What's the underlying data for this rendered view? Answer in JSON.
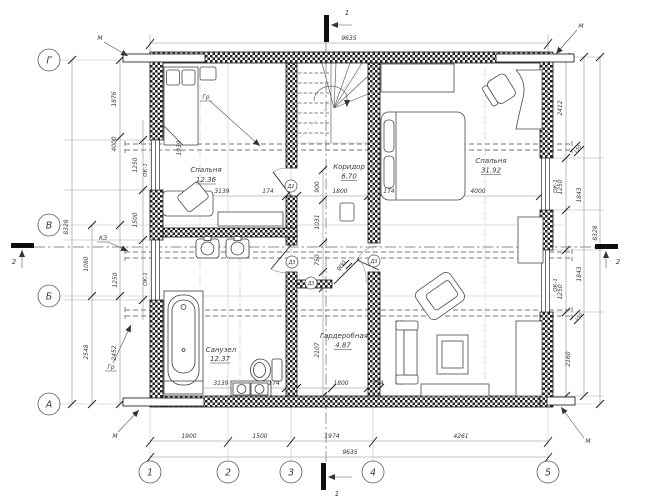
{
  "axes": {
    "rows": [
      "Г",
      "В",
      "Б",
      "А"
    ],
    "cols": [
      "1",
      "2",
      "3",
      "4",
      "5"
    ]
  },
  "sections": {
    "s1": "1",
    "s2": "2"
  },
  "rooms": [
    {
      "name": "Спальня",
      "area": "12.36"
    },
    {
      "name": "Коридор",
      "area": "6.70"
    },
    {
      "name": "Спальня",
      "area": "31.92"
    },
    {
      "name": "Санузел",
      "area": "12.37"
    },
    {
      "name": "Гардеробная",
      "area": "4.87"
    }
  ],
  "labels": {
    "window": "ОК-1",
    "door_d2": "Д2",
    "door_d3": "Д3",
    "corner_mark": "М",
    "floor_mark": "Гр",
    "kz_mark": "КЗ"
  },
  "dims": {
    "top_total": "9635",
    "bottom_segments": [
      "1900",
      "1500",
      "1974",
      "4261"
    ],
    "bottom_total": "9635",
    "left": {
      "total": "8328",
      "g_v": "4000",
      "v_b": "1080",
      "b_a": "2548",
      "b_a2": "2452",
      "pier_top": "1876",
      "window1": "1250",
      "pier_mid": "1500",
      "window2": "1250"
    },
    "right": {
      "total": "8328",
      "top": "2412",
      "window1": "1250",
      "mid1": "1843",
      "mid2": "1843",
      "window2": "1250",
      "bottom": "2160",
      "duct": "150"
    },
    "interior": {
      "room1_width": "3139",
      "wall_t": "174",
      "corridor_width": "1800",
      "big_width": "4000",
      "bath_width": "3139",
      "ward_width": "1800",
      "corridor_v1": "900",
      "corridor_v2": "1031",
      "corridor_v3": "750",
      "door_width": "900",
      "ward_height": "2107",
      "bed_length": "1939"
    }
  }
}
